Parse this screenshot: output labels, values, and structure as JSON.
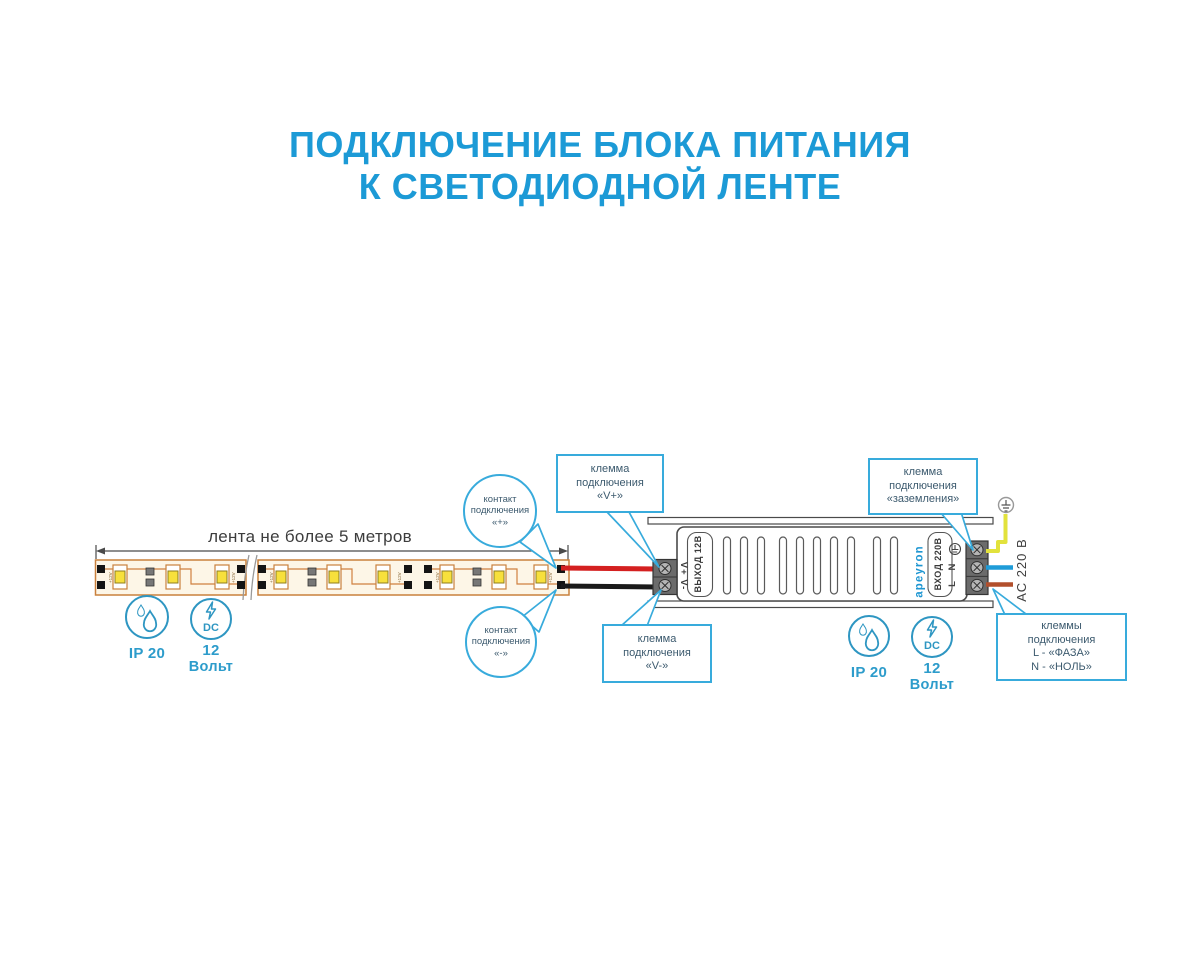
{
  "title": {
    "line1": "ПОДКЛЮЧЕНИЕ БЛОКА ПИТАНИЯ",
    "line2": "К СВЕТОДИОДНОЙ ЛЕНТЕ"
  },
  "strip": {
    "dimension_label": "лента не более 5 метров",
    "pad_label": "+12V"
  },
  "badges": {
    "ip_rating": "IP 20",
    "dc_label": "DC",
    "voltage_value": "12",
    "voltage_unit": "Вольт"
  },
  "psu": {
    "brand": "apeyron",
    "output_label": "ВЫХОД 12В",
    "output_terminals": "V+ V-",
    "input_label": "ВХОД 220В",
    "terminal_n": "N",
    "terminal_l": "L",
    "ac_label": "АС 220 В"
  },
  "callouts": {
    "contact_plus": {
      "lines": [
        "контакт",
        "подключения",
        "«+»"
      ]
    },
    "contact_minus": {
      "lines": [
        "контакт",
        "подключения",
        "«-»"
      ]
    },
    "terminal_vplus": {
      "lines": [
        "клемма",
        "подключения",
        "«V+»"
      ]
    },
    "terminal_vminus": {
      "lines": [
        "клемма",
        "подключения",
        "«V-»"
      ]
    },
    "terminal_ground": {
      "lines": [
        "клемма",
        "подключения",
        "«заземления»"
      ]
    },
    "terminal_mains": {
      "lines": [
        "клеммы",
        "подключения",
        "L - «ФАЗА»",
        "N - «НОЛЬ»"
      ]
    }
  },
  "colors": {
    "accent_blue": "#1c9ad6",
    "callout_border": "#38abdc",
    "callout_text": "#3c5a6e",
    "icon_blue": "#2e9ac6",
    "wire_red": "#d42020",
    "wire_black": "#1a1a1a",
    "wire_yellow": "#e2e23c",
    "wire_blue": "#1f9cd8",
    "wire_brown": "#b24f2c",
    "strip_trace": "#d08040",
    "led_yellow": "#f7e03c"
  }
}
